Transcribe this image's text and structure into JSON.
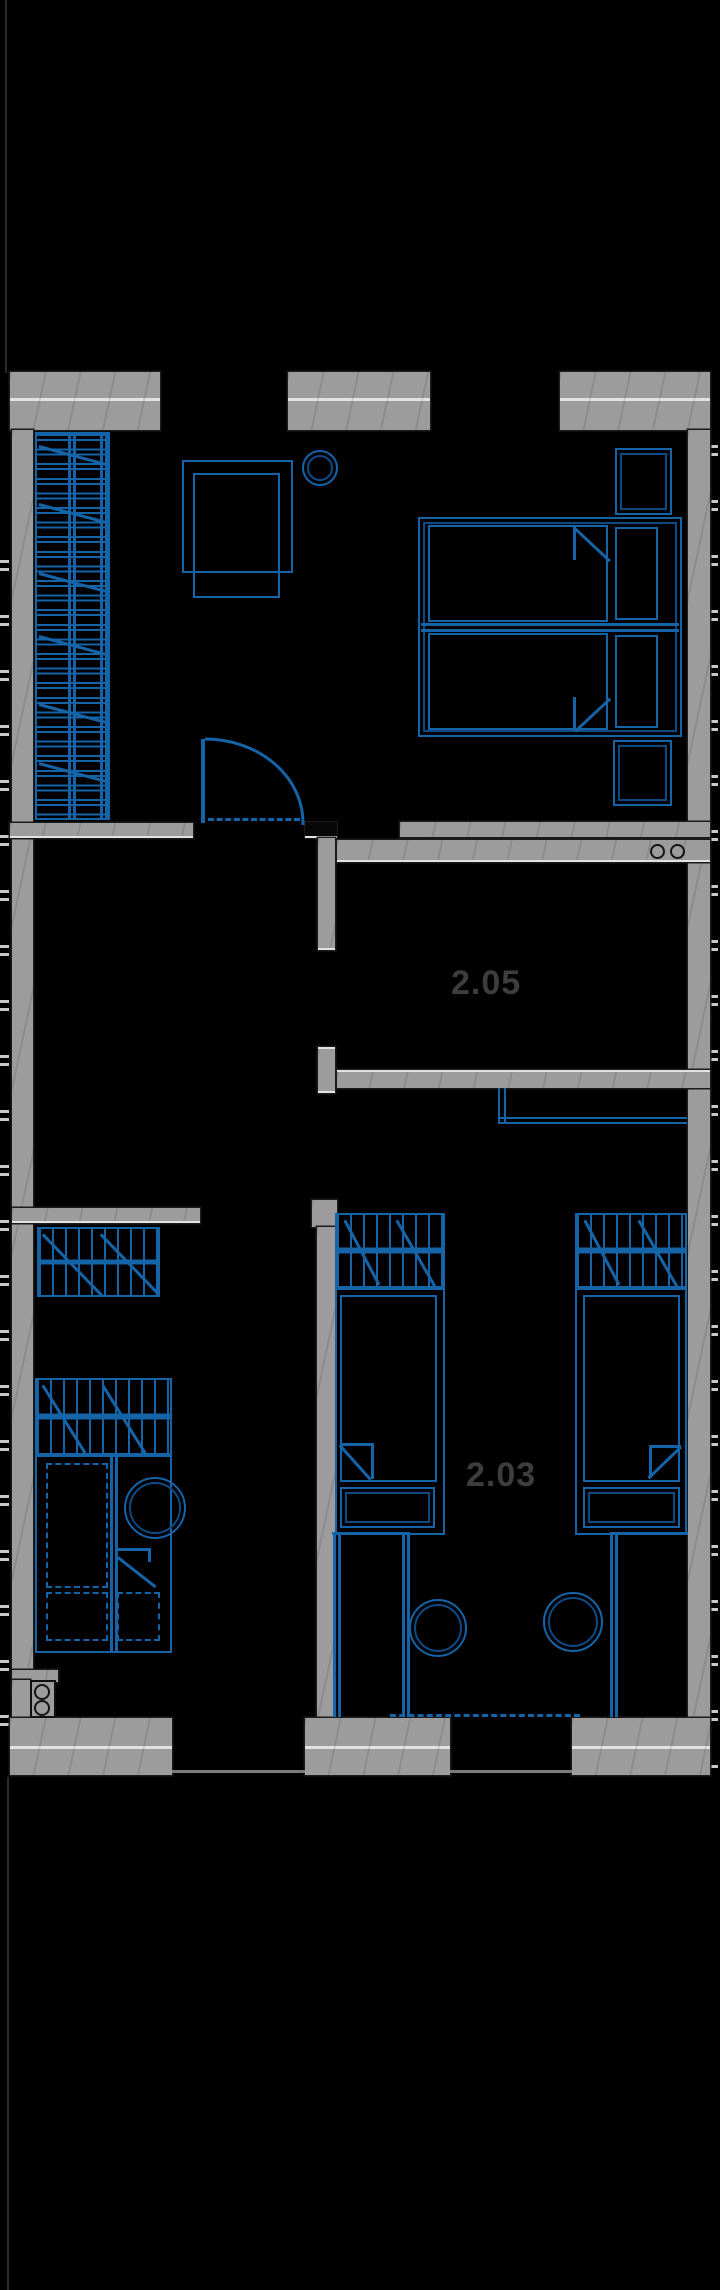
{
  "plan": {
    "type": "floor-plan",
    "rooms": [
      {
        "label": "2.05"
      },
      {
        "label": "2.03"
      }
    ],
    "symbols": [
      "staircase",
      "door-swing",
      "double-bed",
      "nightstand",
      "desk",
      "chair",
      "stool",
      "wardrobe",
      "single-bed",
      "handrail",
      "cooktop",
      "window-ticks"
    ]
  },
  "colors": {
    "bg": "#000000",
    "wall": "#9c9c9c",
    "wall-light": "#e2e2e2",
    "blue": "#1564a8",
    "blue-dark": "#0d4a85",
    "tick": "#c9c9c9",
    "label": "#3d3d3d",
    "boundary": "#2b2b2b"
  }
}
